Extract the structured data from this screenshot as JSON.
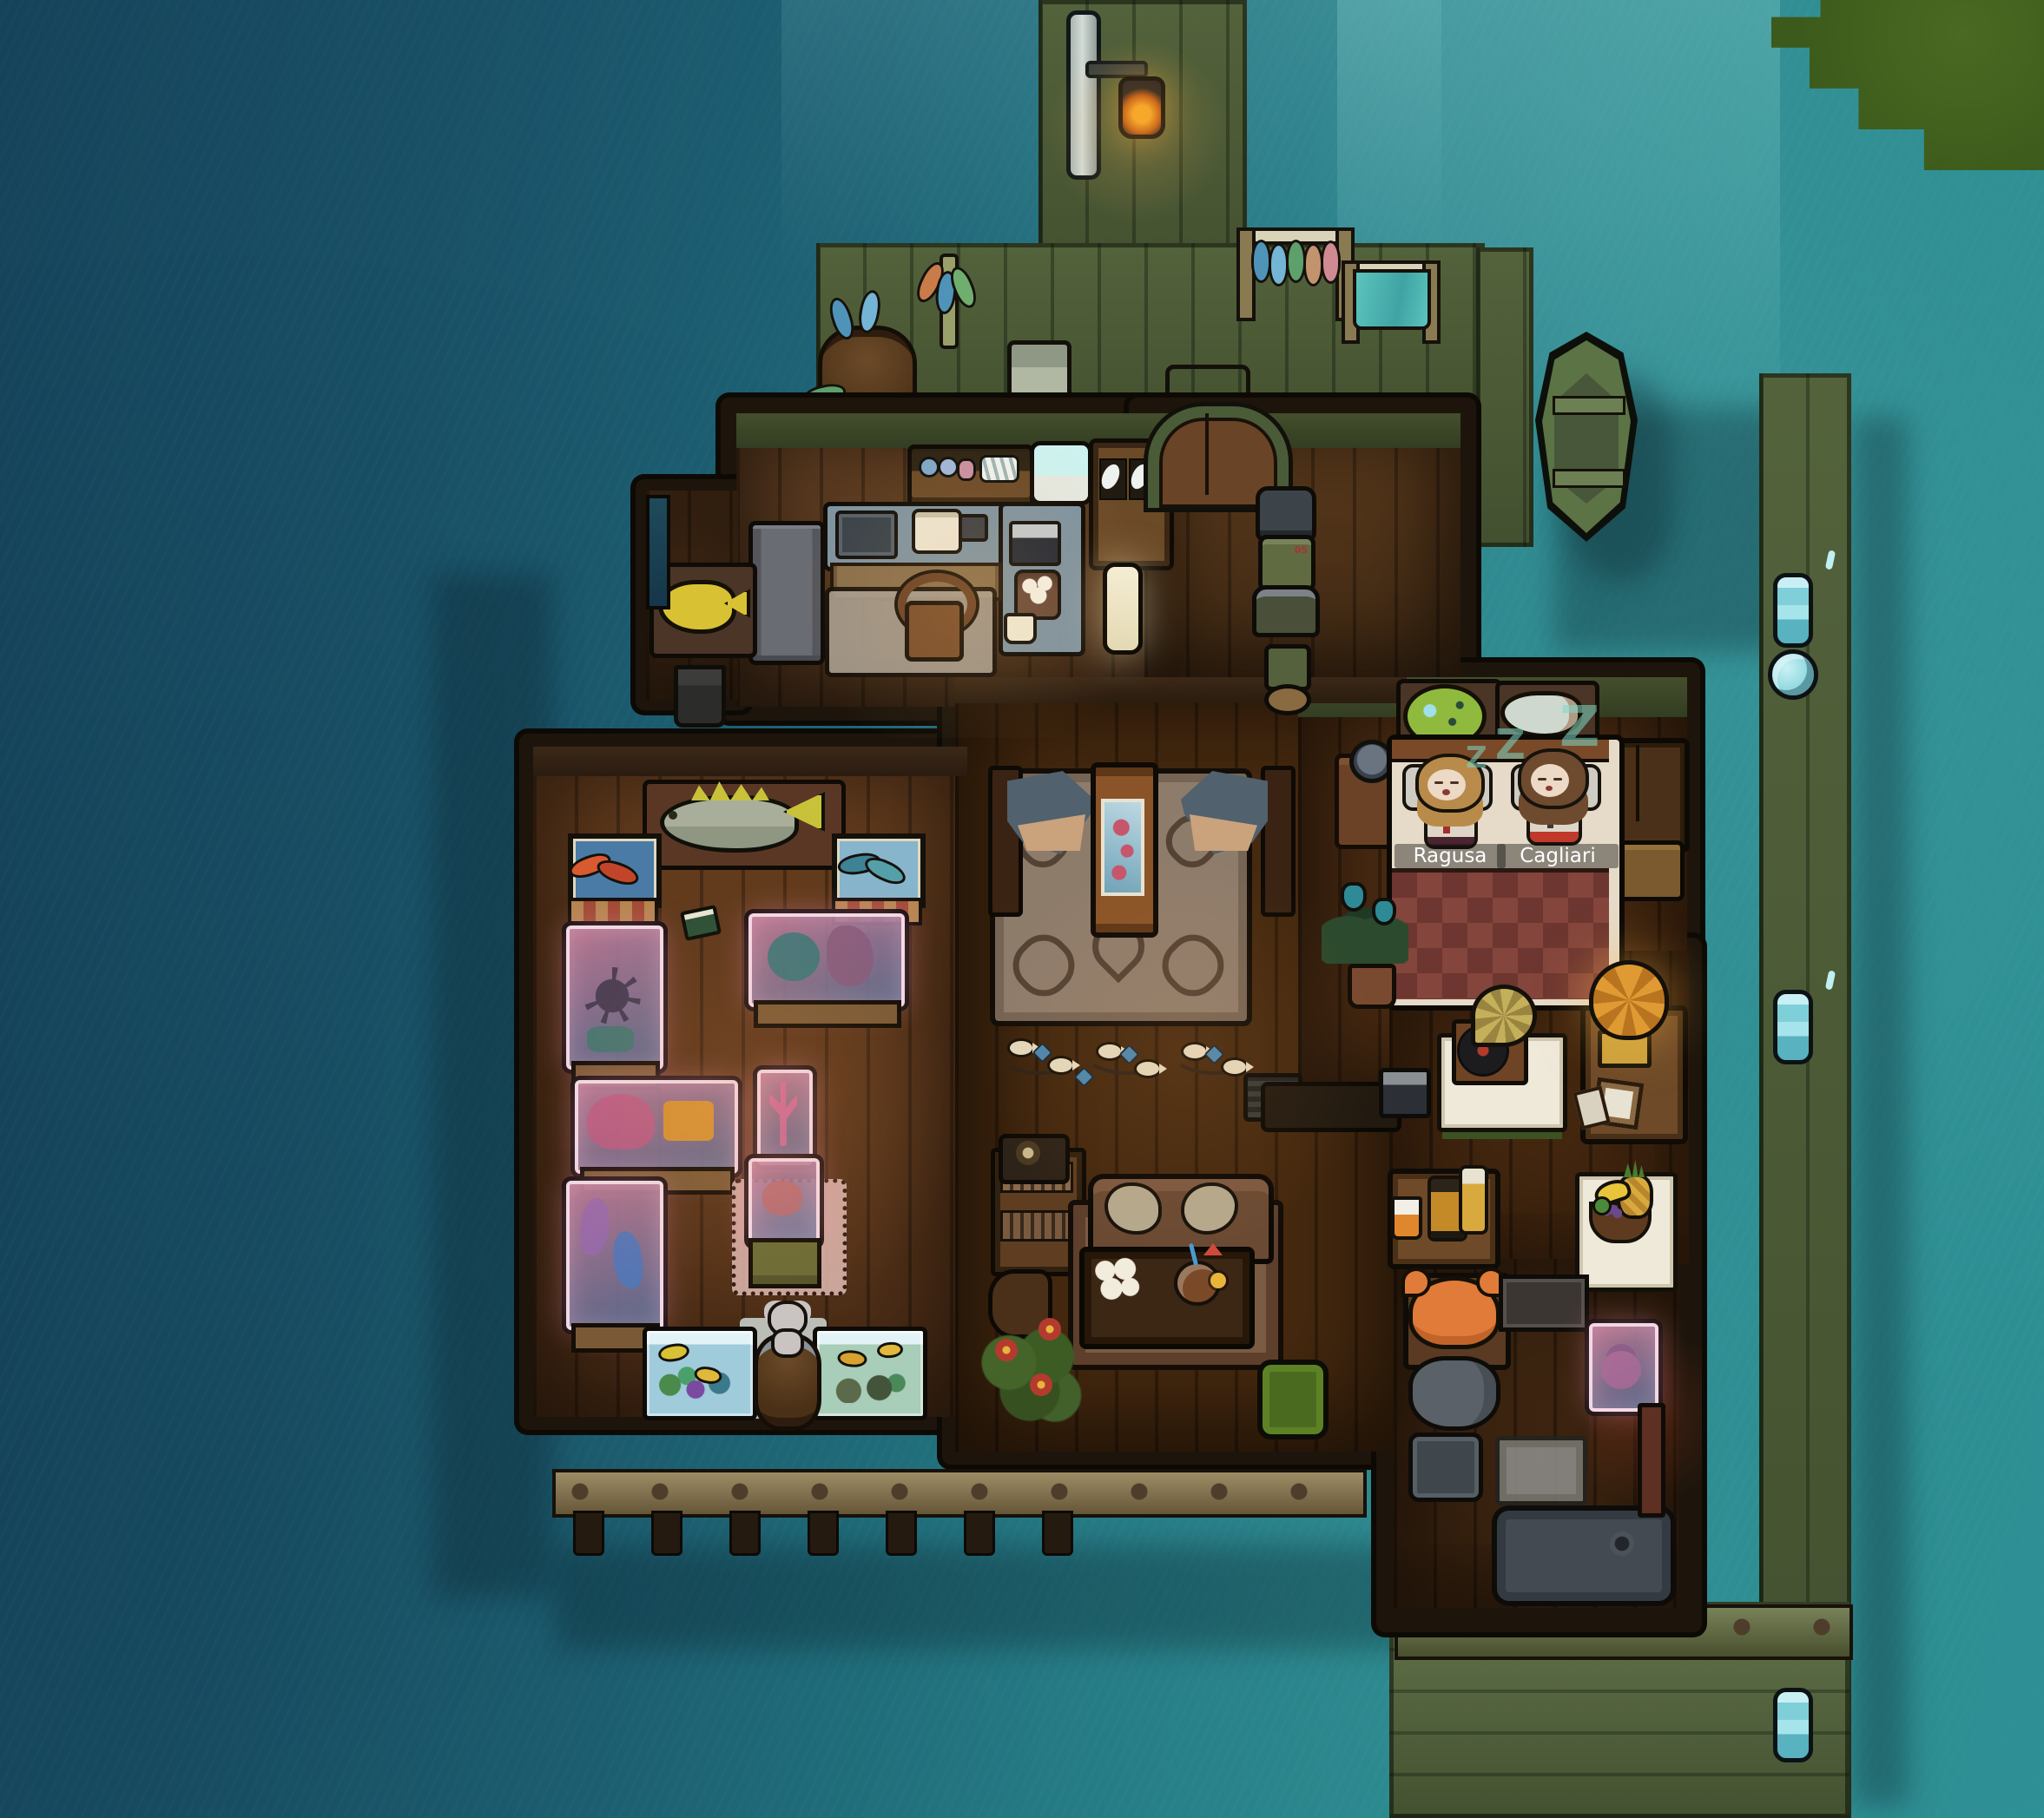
{
  "hud": {
    "character_labels": [
      {
        "name": "Ragusa"
      },
      {
        "name": "Cagliari"
      }
    ],
    "sleep_indicator": {
      "glyph": "Z"
    }
  },
  "armor_stand": {
    "chest_mark": "05"
  },
  "palette": {
    "water_deep": "#15435a",
    "water_teal": "#2e9094",
    "dock_olive": "#5c6c41",
    "floor_wood": "#5a3a20",
    "tank_glow_pink": "#e8a8c0",
    "blanket_red": "#84453c",
    "sleep_teal": "#7ed8c6",
    "lamp_amber": "#d28a2b",
    "grass_green": "#42611d"
  },
  "inventory": {
    "pier": [
      "lamp post with lantern",
      "fish drying rack",
      "towel rack",
      "barrel of fish",
      "kelp decoration",
      "wicker crate",
      "glass pane",
      "rowboat",
      "soccer ball",
      "mooring bollards"
    ],
    "kitchen": [
      "wall shelf with jars and plates",
      "white basin",
      "china hutch",
      "counter with sink",
      "satchel",
      "mug",
      "radio",
      "flower pot",
      "coffee cup",
      "chair",
      "rug",
      "fridge",
      "yellow fish trophy",
      "trash bin",
      "paper lantern"
    ],
    "hall": [
      "arched double door",
      "armor display stand"
    ],
    "bedroom": [
      "double bed",
      "pufferfish trophy",
      "feather fish trophy",
      "wardrobe",
      "suitcase",
      "nightstand with alarm clock",
      "potted tulip plant"
    ],
    "living_room": [
      "shark head trophy x2",
      "floral column clock",
      "celtic rug",
      "fish garland",
      "radiator",
      "bench",
      "bookshelf with telephone",
      "armchair",
      "sofa",
      "coffee table with tea set and coconut drink",
      "flower bush",
      "green pouf",
      "gramophone table",
      "small radio",
      "lamp side table",
      "picture frames",
      "drinks table",
      "fruit table"
    ],
    "gallery": [
      "large fish trophy",
      "red fish picture",
      "blue fish picture",
      "squid display tank",
      "ship wheel display tank",
      "octopus and treasure display tank",
      "seahorse display tank",
      "coral column tank",
      "crab display tank",
      "aquarium x2",
      "barrel with teddy bear",
      "green book"
    ],
    "bathroom": [
      "crab table",
      "wall cabinets",
      "anemone tank",
      "toilet",
      "sink",
      "bath mat",
      "bathtub",
      "door"
    ]
  }
}
